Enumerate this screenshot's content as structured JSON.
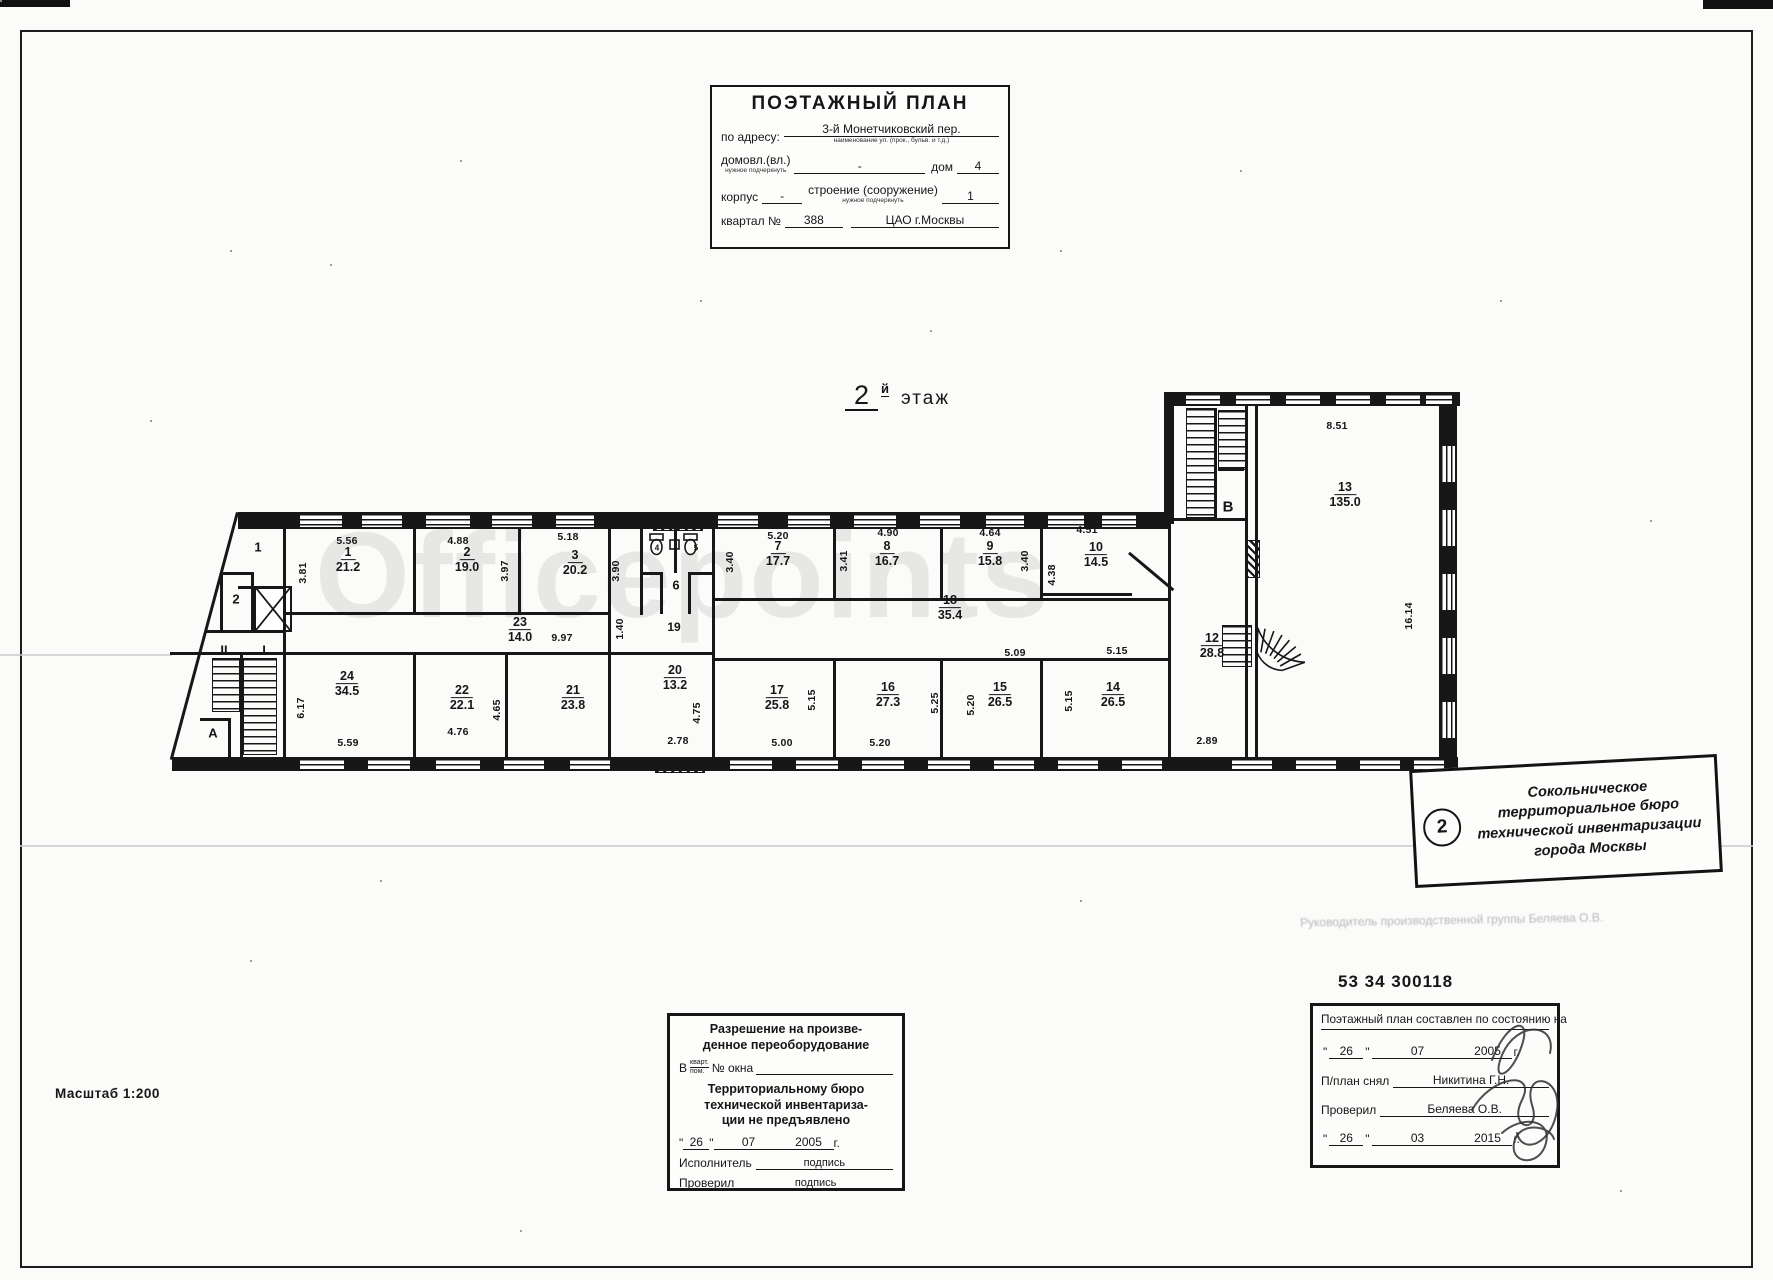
{
  "title_block": {
    "title": "ПОЭТАЖНЫЙ ПЛАН",
    "address_label": "по адресу:",
    "address_value": "3-й Монетчиковский пер.",
    "address_caption": "наименование ул. (прок., бульв. и т.д.)",
    "domovl_label": "домовл.(вл.)",
    "domovl_caption": "нужное подчеркнуть",
    "domovl_value": "-",
    "dom_label": "дом",
    "dom_value": "4",
    "korpus_label": "корпус",
    "korpus_value": "-",
    "stroenie_label": "строение (сооружение)",
    "stroenie_caption": "нужное подчеркнуть",
    "stroenie_value": "1",
    "kvartal_label": "квартал №",
    "kvartal_value": "388",
    "okrug_value": "ЦАО г.Москвы"
  },
  "floor_label": {
    "num": "2",
    "sup": "й",
    "word": "этаж"
  },
  "watermark": "Officepoints",
  "inventory_number": "53 34 300118",
  "faint_note": "Руководитель производственной группы Беляева О.В.",
  "scale_label": "Масштаб 1:200",
  "stamp": {
    "badge": "2",
    "lines": [
      "Сокольническое",
      "территориальное бюро",
      "технической инвентаризации",
      "города Москвы"
    ]
  },
  "approval_box": {
    "title1": "Разрешение на произве-",
    "title2": "денное переоборудование",
    "in_label": "В",
    "frac_top": "кварт.",
    "frac_bottom": "пом.",
    "okna_label": "№ окна",
    "body1": "Территориальному бюро",
    "body2": "технической инвентариза-",
    "body3": "ции не предъявлено",
    "day": "26",
    "month": "07",
    "year": "2005",
    "g": "г.",
    "exec_label": "Исполнитель",
    "exec_value": "подпись",
    "check_label": "Проверил",
    "check_value": "подпись"
  },
  "date_box": {
    "header": "Поэтажный план составлен по состоянию на",
    "day1": "26",
    "month1": "07",
    "year1": "2005",
    "g1": "г.",
    "snyal_label": "П/план снял",
    "snyal_value": "Никитина Г.Н.",
    "check_label": "Проверил",
    "check_value": "Беляева О.В.",
    "day2": "26",
    "month2": "03",
    "year2": "2015",
    "g2": "г."
  },
  "plan": {
    "rooms": [
      {
        "num": "1",
        "area": "21.2",
        "x": 348,
        "y": 560
      },
      {
        "num": "2",
        "area": "19.0",
        "x": 467,
        "y": 560
      },
      {
        "num": "3",
        "area": "20.2",
        "x": 575,
        "y": 563
      },
      {
        "num": "7",
        "area": "17.7",
        "x": 778,
        "y": 554
      },
      {
        "num": "8",
        "area": "16.7",
        "x": 887,
        "y": 554
      },
      {
        "num": "9",
        "area": "15.8",
        "x": 990,
        "y": 554
      },
      {
        "num": "10",
        "area": "14.5",
        "x": 1096,
        "y": 555
      },
      {
        "num": "23",
        "area": "14.0",
        "x": 520,
        "y": 630
      },
      {
        "num": "18",
        "area": "35.4",
        "x": 950,
        "y": 608
      },
      {
        "num": "24",
        "area": "34.5",
        "x": 347,
        "y": 684
      },
      {
        "num": "22",
        "area": "22.1",
        "x": 462,
        "y": 698
      },
      {
        "num": "21",
        "area": "23.8",
        "x": 573,
        "y": 698
      },
      {
        "num": "20",
        "area": "13.2",
        "x": 675,
        "y": 678
      },
      {
        "num": "17",
        "area": "25.8",
        "x": 777,
        "y": 698
      },
      {
        "num": "16",
        "area": "27.3",
        "x": 888,
        "y": 695
      },
      {
        "num": "15",
        "area": "26.5",
        "x": 1000,
        "y": 695
      },
      {
        "num": "14",
        "area": "26.5",
        "x": 1113,
        "y": 695
      },
      {
        "num": "12",
        "area": "28.8",
        "x": 1212,
        "y": 646
      },
      {
        "num": "13",
        "area": "135.0",
        "x": 1345,
        "y": 495
      }
    ],
    "dims": [
      {
        "t": "5.56",
        "x": 347,
        "y": 541
      },
      {
        "t": "3.81",
        "x": 303,
        "y": 573,
        "v": 1
      },
      {
        "t": "4.88",
        "x": 458,
        "y": 541
      },
      {
        "t": "3.97",
        "x": 505,
        "y": 571,
        "v": 1
      },
      {
        "t": "5.18",
        "x": 568,
        "y": 537
      },
      {
        "t": "3.90",
        "x": 616,
        "y": 571,
        "v": 1
      },
      {
        "t": "3.40",
        "x": 730,
        "y": 562,
        "v": 1
      },
      {
        "t": "5.20",
        "x": 778,
        "y": 536
      },
      {
        "t": "3.41",
        "x": 844,
        "y": 561,
        "v": 1
      },
      {
        "t": "4.90",
        "x": 888,
        "y": 533
      },
      {
        "t": "4.64",
        "x": 990,
        "y": 533
      },
      {
        "t": "3.40",
        "x": 1025,
        "y": 561,
        "v": 1
      },
      {
        "t": "4.51",
        "x": 1087,
        "y": 530
      },
      {
        "t": "4.38",
        "x": 1052,
        "y": 575,
        "v": 1
      },
      {
        "t": "8.51",
        "x": 1337,
        "y": 426
      },
      {
        "t": "16.14",
        "x": 1409,
        "y": 616,
        "v": 1
      },
      {
        "t": "9.97",
        "x": 562,
        "y": 638
      },
      {
        "t": "1.40",
        "x": 620,
        "y": 629,
        "v": 1
      },
      {
        "t": "6.17",
        "x": 301,
        "y": 708,
        "v": 1
      },
      {
        "t": "5.59",
        "x": 348,
        "y": 743
      },
      {
        "t": "4.76",
        "x": 458,
        "y": 732
      },
      {
        "t": "4.65",
        "x": 497,
        "y": 710,
        "v": 1
      },
      {
        "t": "2.78",
        "x": 678,
        "y": 741
      },
      {
        "t": "4.75",
        "x": 697,
        "y": 713,
        "v": 1
      },
      {
        "t": "5.00",
        "x": 782,
        "y": 743
      },
      {
        "t": "5.15",
        "x": 812,
        "y": 700,
        "v": 1
      },
      {
        "t": "5.20",
        "x": 880,
        "y": 743
      },
      {
        "t": "5.25",
        "x": 935,
        "y": 703,
        "v": 1
      },
      {
        "t": "5.09",
        "x": 1015,
        "y": 653
      },
      {
        "t": "5.20",
        "x": 971,
        "y": 705,
        "v": 1
      },
      {
        "t": "5.15",
        "x": 1117,
        "y": 651
      },
      {
        "t": "5.15",
        "x": 1069,
        "y": 701,
        "v": 1
      },
      {
        "t": "2.89",
        "x": 1207,
        "y": 741
      }
    ],
    "letters": [
      {
        "t": "В",
        "x": 1228,
        "y": 507,
        "s": 15
      },
      {
        "t": "А",
        "x": 213,
        "y": 733,
        "s": 13
      },
      {
        "t": "I",
        "x": 264,
        "y": 650,
        "s": 13
      },
      {
        "t": "II",
        "x": 224,
        "y": 650,
        "s": 13
      },
      {
        "t": "1",
        "x": 258,
        "y": 547,
        "s": 13
      },
      {
        "t": "2",
        "x": 236,
        "y": 599,
        "s": 13
      },
      {
        "t": "6",
        "x": 676,
        "y": 585,
        "s": 13
      },
      {
        "t": "19",
        "x": 674,
        "y": 627,
        "s": 12
      },
      {
        "t": "4",
        "x": 657,
        "y": 548,
        "s": 8
      },
      {
        "t": "5",
        "x": 696,
        "y": 548,
        "s": 8
      }
    ]
  }
}
